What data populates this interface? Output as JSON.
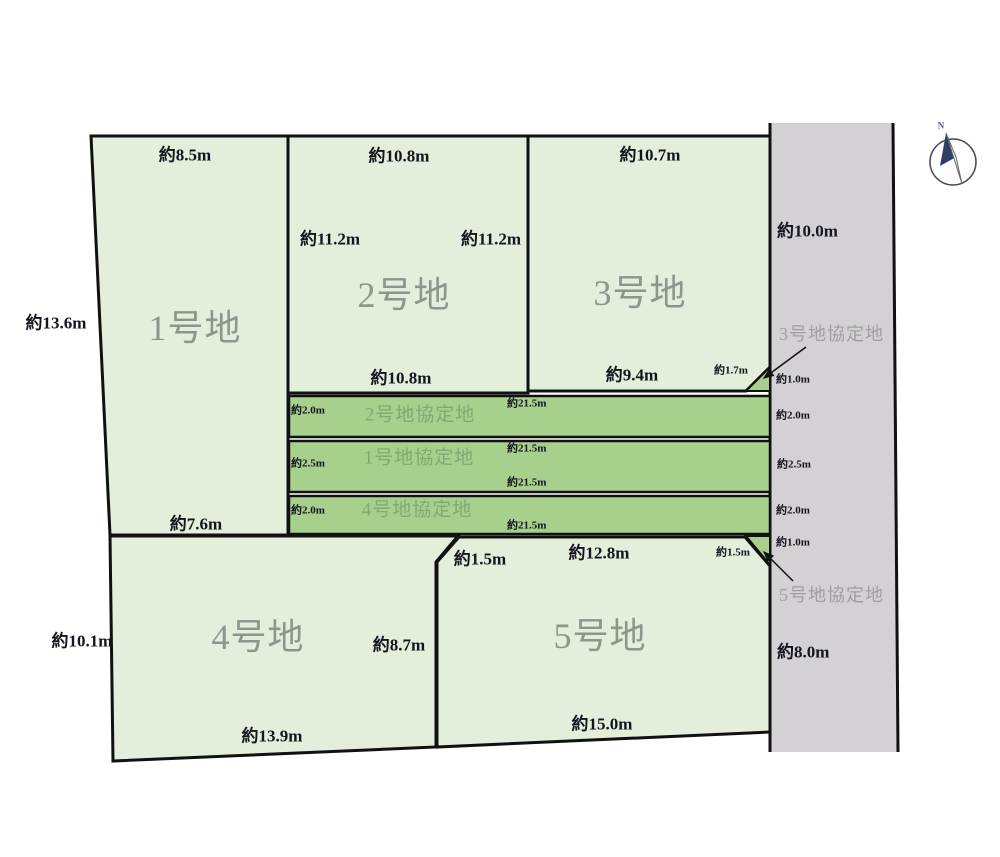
{
  "diagram_type": "land-lot-layout",
  "lots": {
    "lot1": {
      "name": "1号地",
      "dim_top": "約8.5m",
      "dim_left": "約13.6m",
      "dim_bottom": "約7.6m"
    },
    "lot2": {
      "name": "2号地",
      "dim_top": "約10.8m",
      "dim_left": "約11.2m",
      "dim_right": "約11.2m",
      "dim_bottom": "約10.8m"
    },
    "lot3": {
      "name": "3号地",
      "dim_top": "約10.7m",
      "dim_bottom": "約9.4m",
      "dim_corner_cut": "約1.7m"
    },
    "lot4": {
      "name": "4号地",
      "dim_left": "約10.1m",
      "dim_right": "約8.7m",
      "dim_bottom": "約13.9m"
    },
    "lot5": {
      "name": "5号地",
      "dim_top": "約12.8m",
      "dim_corner_top_left": "約1.5m",
      "dim_corner_top_right": "約1.5m",
      "dim_bottom": "約15.0m"
    }
  },
  "agreement_strips": {
    "lot2_strip": {
      "name": "2号地協定地",
      "dim_width": "約2.0m",
      "dim_length_top": "約21.5m"
    },
    "lot1_strip": {
      "name": "1号地協定地",
      "dim_width": "約2.5m",
      "dim_length_top": "約21.5m",
      "dim_length_bottom": "約21.5m"
    },
    "lot4_strip": {
      "name": "4号地協定地",
      "dim_width": "約2.0m",
      "dim_length_bottom": "約21.5m"
    },
    "lot3_strip": {
      "name": "3号地協定地",
      "dim_width": "約1.0m"
    },
    "lot5_strip": {
      "name": "5号地協定地",
      "dim_width": "約1.0m"
    }
  },
  "road": {
    "dim_top": "約10.0m",
    "dim_bottom": "約8.0m",
    "side_dims": {
      "lot2_strip": "約2.0m",
      "lot1_strip": "約2.5m",
      "lot4_strip": "約2.0m"
    }
  },
  "compass": {
    "north": "N"
  },
  "colors": {
    "lot_fill": "#e3eedb",
    "agreement_fill": "#a6d08c",
    "road_fill": "#d3d1d3",
    "outline": "#111111",
    "lot_label_text": "#8d968d",
    "dimension_text": "#15151f",
    "agreement_label_text": "#82a873",
    "road_label_text": "#9f9f9f",
    "compass_needle_dark": "#2e3f66"
  }
}
